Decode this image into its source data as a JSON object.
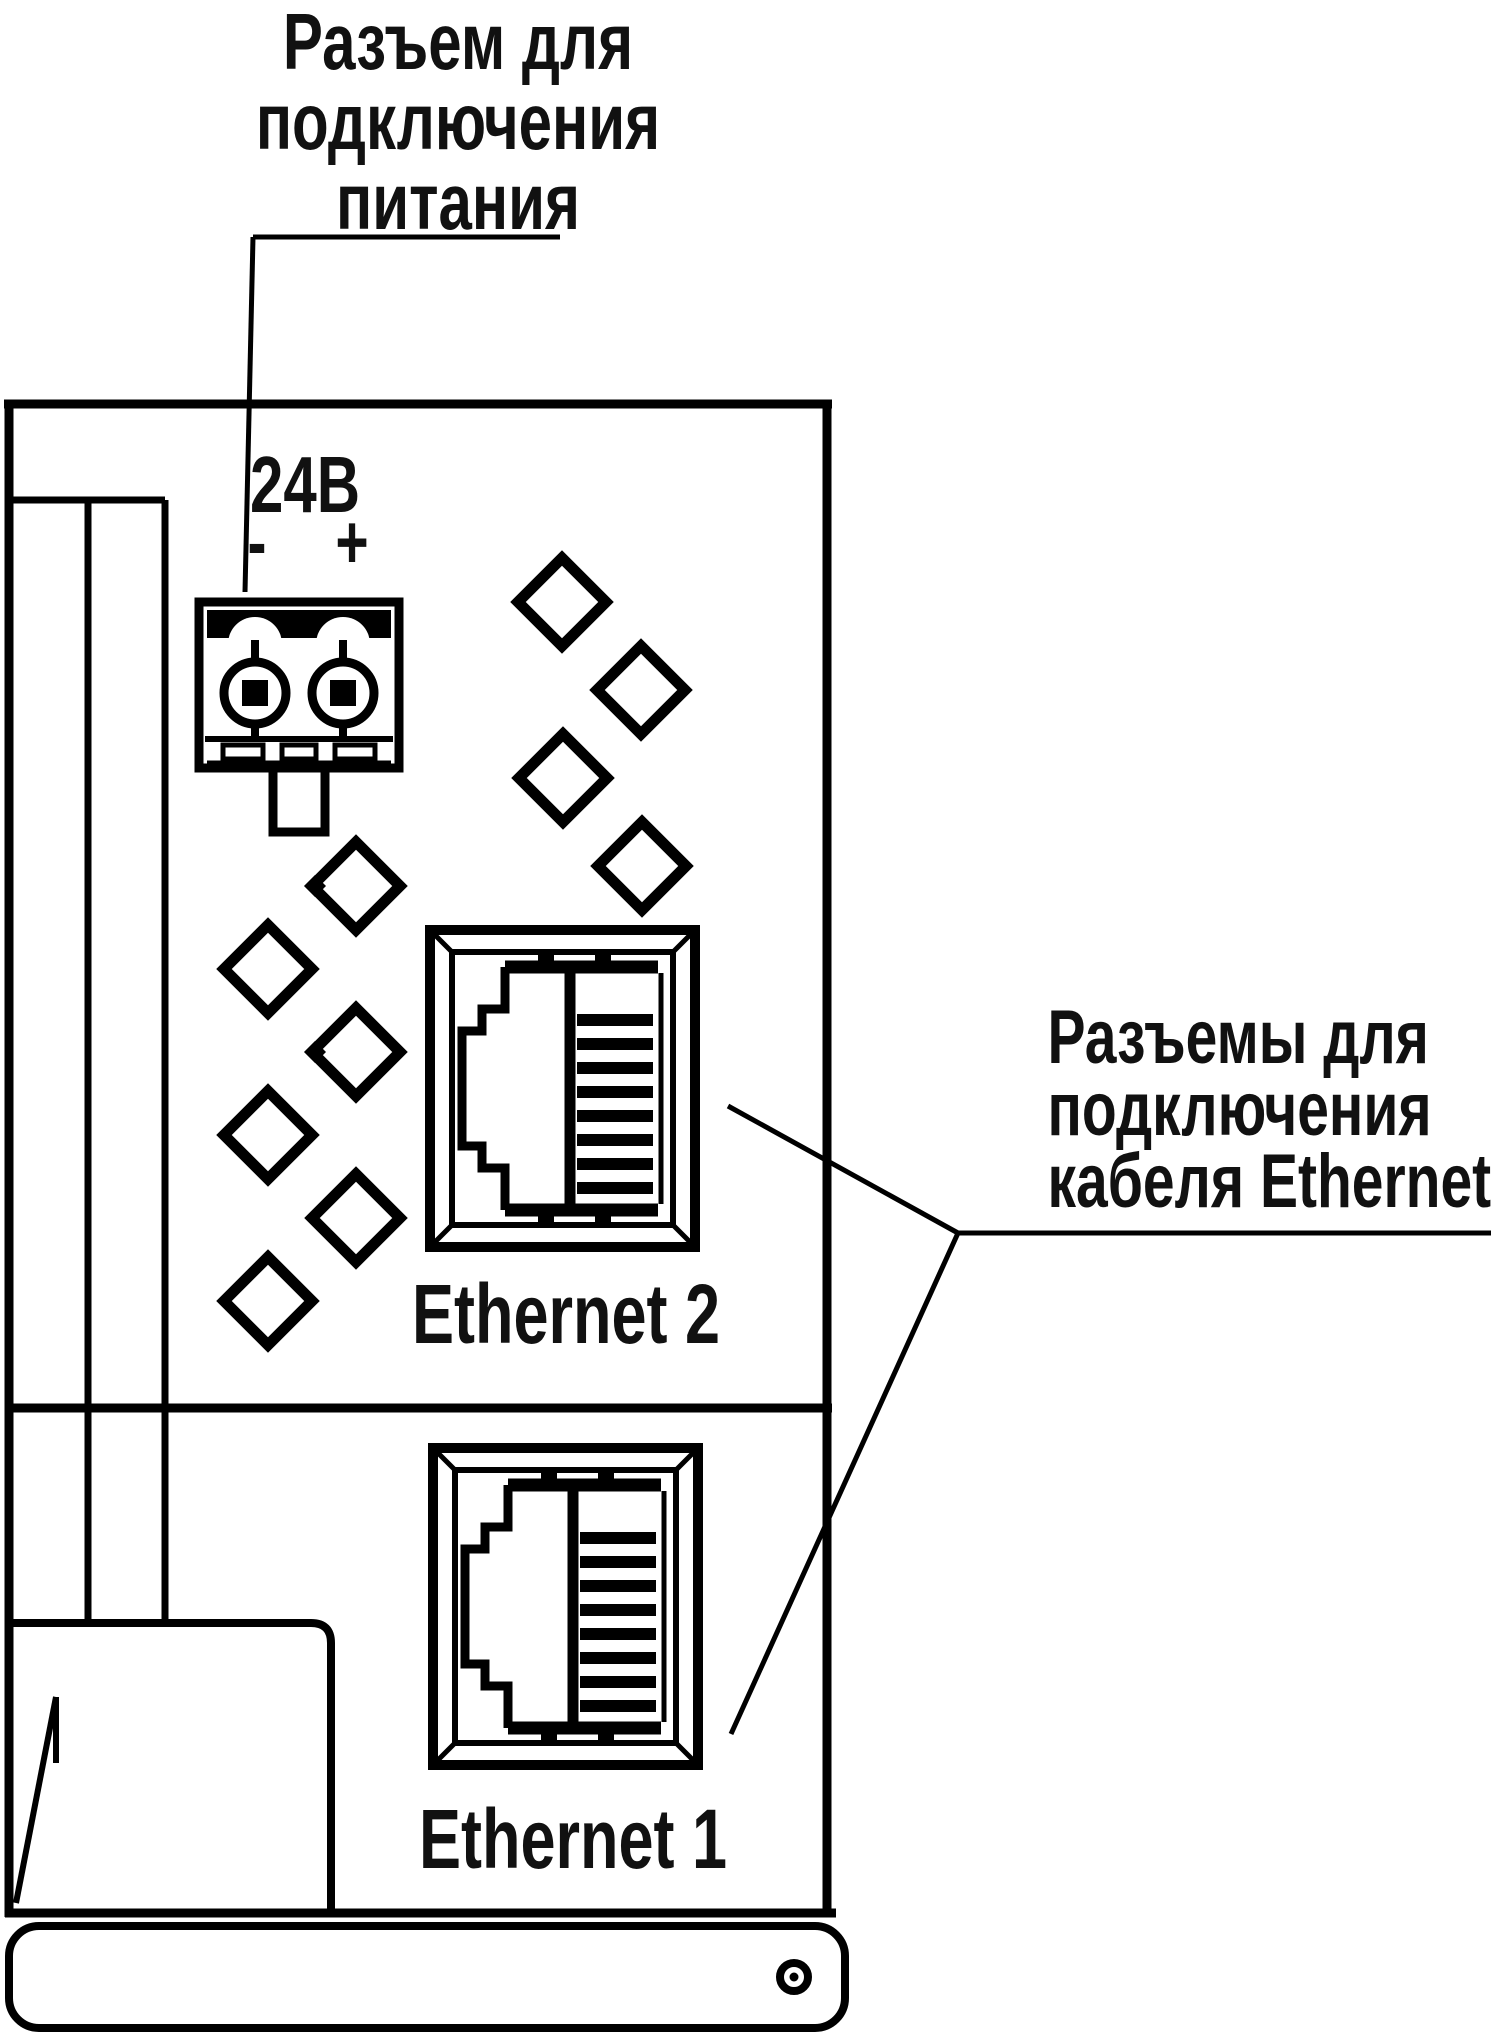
{
  "title": "device-side-panel-diagram",
  "colors": {
    "ink": "#000000",
    "paper": "#ffffff",
    "text": "#111111"
  },
  "annotations": {
    "power": {
      "line1": "Разъем для",
      "line2": "подключения",
      "line3": "питания"
    },
    "ethernet": {
      "line1": "Разъемы для",
      "line2": "подключения",
      "line3": "кабеля Ethernet"
    }
  },
  "power_connector": {
    "voltage": "24В",
    "minus": "-",
    "plus": "+"
  },
  "ports": [
    {
      "label": "Ethernet 2"
    },
    {
      "label": "Ethernet 1"
    }
  ]
}
